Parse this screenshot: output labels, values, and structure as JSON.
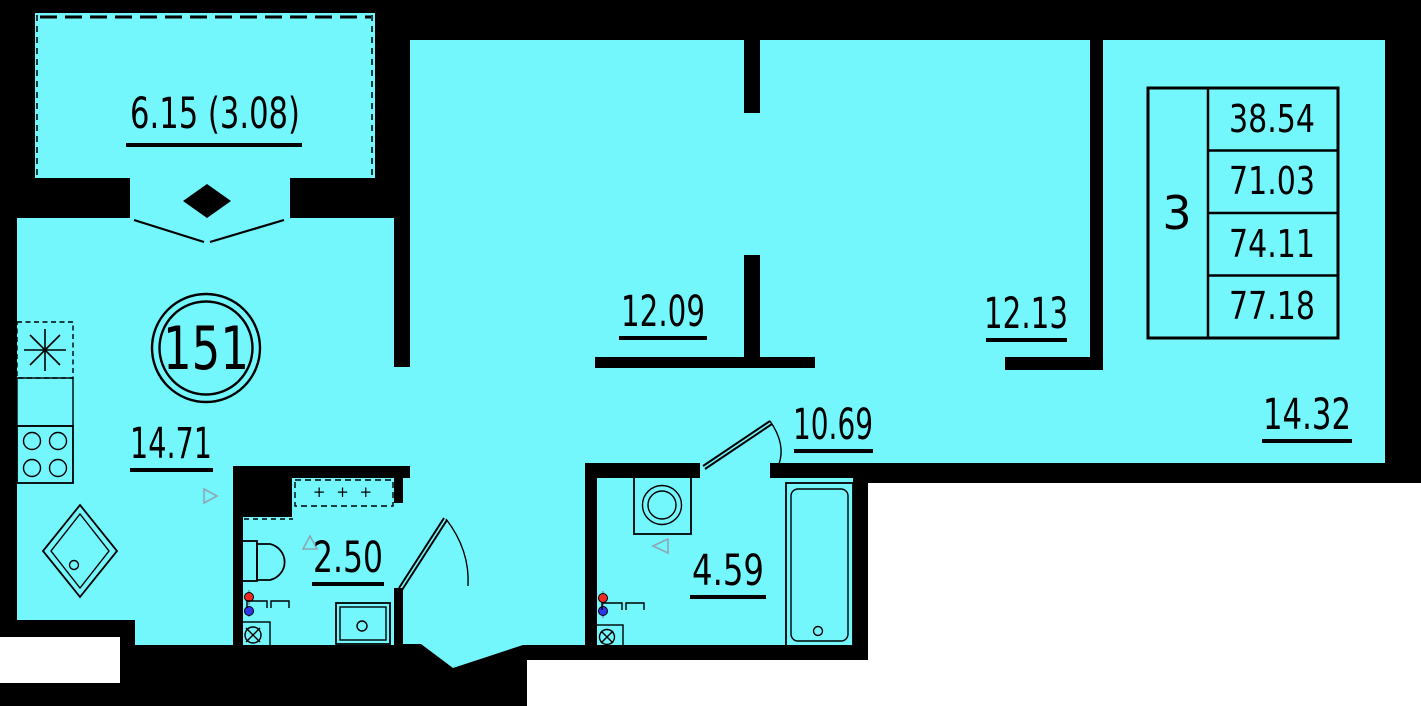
{
  "plan": {
    "apartment_number": "151",
    "labels": {
      "balcony": "6.15 (3.08)",
      "kitchen": "14.71",
      "bath_small": "2.50",
      "room_a": "12.09",
      "hall": "10.69",
      "bath_large": "4.59",
      "room_b": "12.13",
      "room_c": "14.32"
    },
    "info_table": {
      "rooms_count": "3",
      "rows": [
        "38.54",
        "71.03",
        "74.11",
        "77.18"
      ]
    },
    "shelf_marks": "+ + +",
    "colors": {
      "floor": "#74F6FD",
      "wall": "#000000",
      "outside": "#FFFFFF",
      "hot_water": "#F02A23",
      "cold_water": "#2F35EE"
    }
  }
}
